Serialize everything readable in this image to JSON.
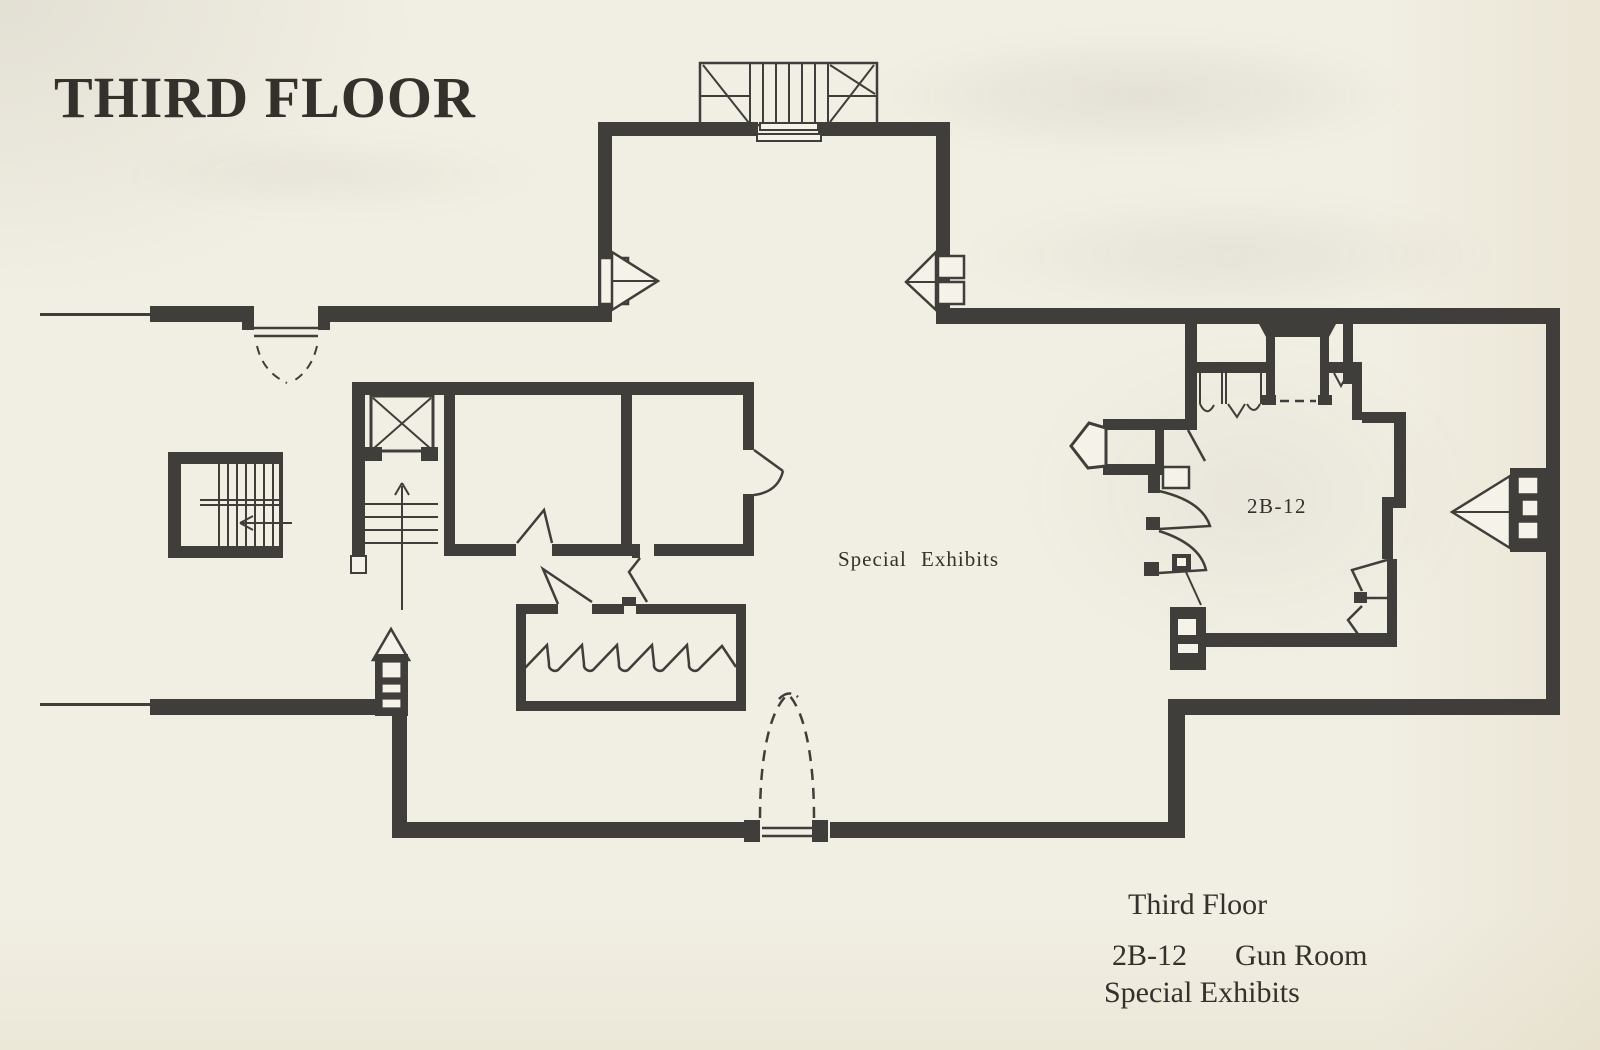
{
  "title": "THIRD FLOOR",
  "plan": {
    "labels": {
      "special_exhibits": "Special Exhibits",
      "gun_room_code": "2B-12"
    },
    "symbols": [
      "top-staircase",
      "left-staircase",
      "elevator",
      "elevator-staircase",
      "west-entry-door",
      "south-arched-entrance",
      "fireplace",
      "bay-window-north-left",
      "bay-window-north-right",
      "bay-window-east",
      "bay-window-south-west",
      "zigzag-exhibit-partition",
      "door-swings"
    ]
  },
  "legend": {
    "line1": "Third Floor",
    "line2_code": "2B-12",
    "line2_name": "Gun Room",
    "line3": "Special Exhibits"
  },
  "colors": {
    "paper": "#f1eee3",
    "paper2": "#f5f2e9",
    "ink": "#403e3a",
    "text": "#34312c"
  }
}
